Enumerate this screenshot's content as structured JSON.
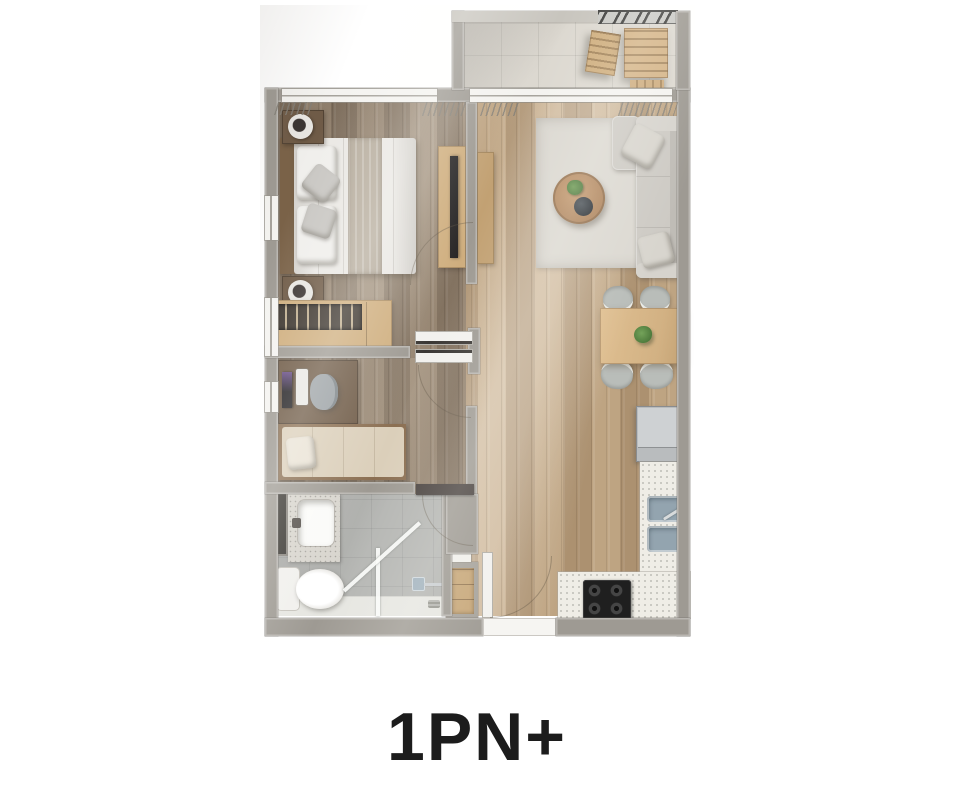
{
  "title": {
    "label": "1PN+"
  },
  "palette": {
    "background": "#ffffff",
    "wall": "#9e9a93",
    "wall_light": "#c8c5be",
    "wall_white": "#f4f3f0",
    "railing_dark": "#3f3f3d",
    "floor_wood_warm": "#b59a78",
    "floor_wood_dark": "#8d7c69",
    "floor_tile_balcony": "#dcd8d0",
    "floor_tile_bath": "#b4b5b2",
    "counter_white": "#efede6",
    "rug": "#dbd8d1",
    "sofa": "#cdcac4",
    "wood_furniture": "#cfae7e",
    "wood_dark_furniture": "#6f5b47",
    "bed_white": "#eae8e4",
    "bed_throw": "#b7ad9e",
    "mattress_single": "#dbcfba",
    "appliance_gray": "#b9bcbe",
    "sink_gray": "#93a4af",
    "stove_black": "#1f1f1f",
    "tv_black": "#262424",
    "plant_green": "#4e7a3c",
    "glass_line": "#f5f6f4",
    "title_color": "#1c1c1c"
  },
  "floorplan": {
    "unit_label": "1PN+",
    "rooms": [
      {
        "id": "balcony",
        "furniture": [
          "railing",
          "outdoor-chair",
          "outdoor-table"
        ]
      },
      {
        "id": "bedroom",
        "furniture": [
          "double-bed",
          "headboard",
          "nightstands",
          "table-lamps",
          "wardrobe",
          "tv-console",
          "tv"
        ]
      },
      {
        "id": "study-room",
        "furniture": [
          "desk",
          "monitor",
          "desk-chair",
          "single-bed"
        ]
      },
      {
        "id": "bathroom",
        "furniture": [
          "vanity-sink",
          "toilet",
          "shower-glass",
          "shower-head"
        ]
      },
      {
        "id": "living-dining",
        "furniture": [
          "sofa",
          "rug",
          "coffee-table",
          "plant",
          "dining-table",
          "dining-chairs"
        ]
      },
      {
        "id": "kitchen",
        "furniture": [
          "fridge",
          "counter",
          "double-sink",
          "cooktop"
        ]
      }
    ]
  }
}
